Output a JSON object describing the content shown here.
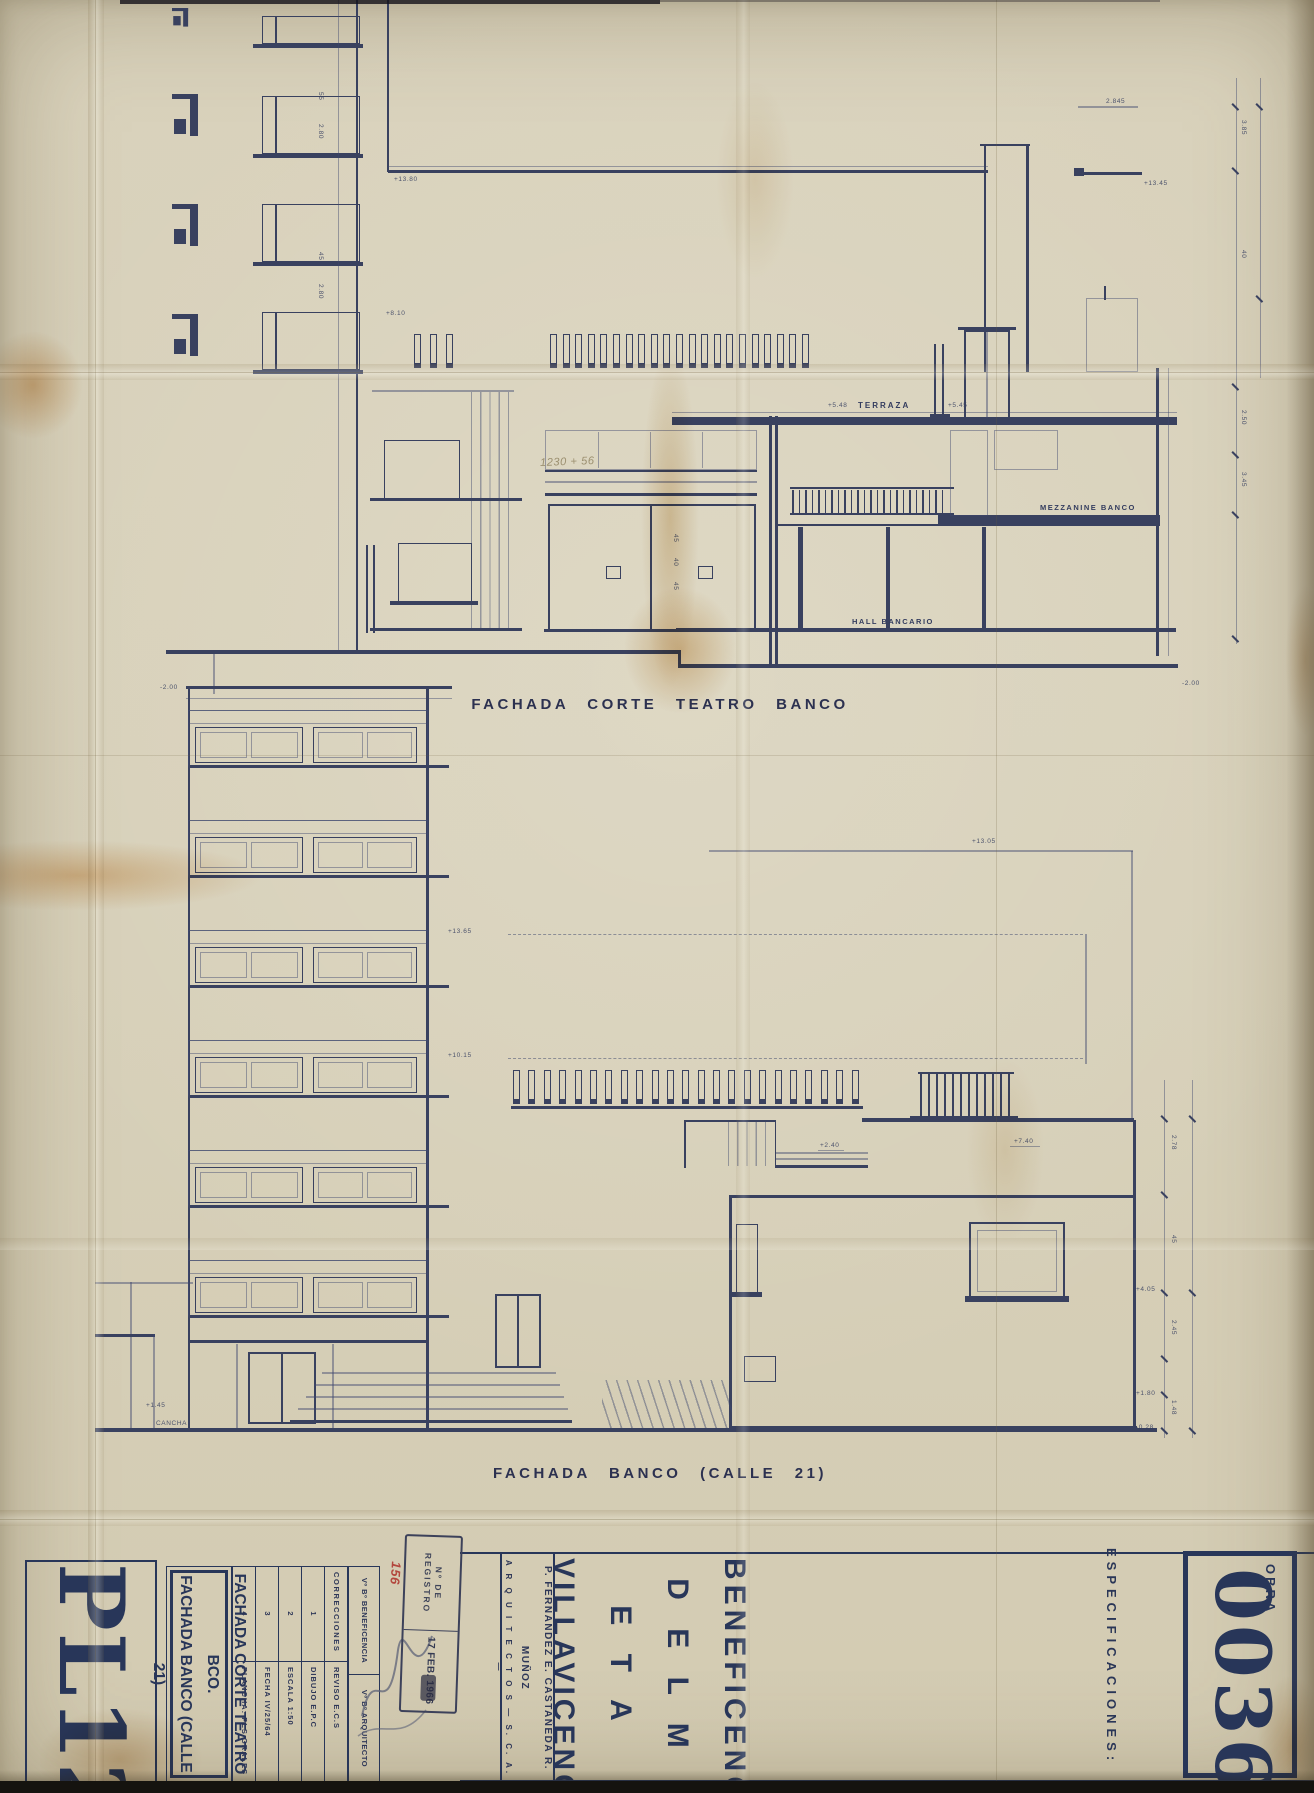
{
  "top": {
    "title": "FACHADA CORTE TEATRO BANCO",
    "terraza": "TERRAZA",
    "mezzanine": "MEZZANINE BANCO",
    "hall": "HALL BANCARIO",
    "lv_roof": "+13.80",
    "lv_845": "2.845",
    "lv_1345": "+13.45",
    "lv_548": "+5.48",
    "lv_545": "+5.45",
    "lv_810": "+8.10",
    "lv_gl": "-2.00",
    "lv_gr": "-2.00",
    "pencil": "1230 + 56",
    "rdims": [
      "3.85",
      "40",
      "2.50",
      "3.45"
    ],
    "ldims": [
      "55",
      "2.80",
      "45",
      "2.80"
    ],
    "adims": [
      "45",
      "40",
      "45"
    ]
  },
  "bottom": {
    "title": "FACHADA BANCO  (CALLE 21)",
    "lv_1365": "+13.65",
    "lv_1015": "+10.15",
    "lv_1305": "+13.05",
    "lv_740": "+7.40",
    "lv_240": "+2.40",
    "lv_405": "+4.05",
    "lv_180": "+1.80",
    "lv_028": "-0.28",
    "lv_145": "+1.45",
    "cancha": "CANCHA",
    "rdims": [
      "2.78",
      "45",
      "2.45",
      "1.48"
    ]
  },
  "tb": {
    "pl": "PL12",
    "t1": "FACHADA CORTE TEATRO BCO.",
    "t2": "FACHADA BANCO (CALLE 21)",
    "corr": {
      "r0": [
        "CORRECCIONES",
        "REVISO   E.C.S"
      ],
      "r1": [
        "1",
        "DIBUJO   E.P.C"
      ],
      "r2": [
        "2",
        "ESCALA   1:50"
      ],
      "r3": [
        "3",
        "FECHA   IV/25/64"
      ],
      "r4": [
        "4",
        "PLANCHA:  PLS  GRALES"
      ]
    },
    "vb1": "Vº Bº  BENEFICENCIA",
    "vb2": "Vº Bº  ARQUITECTO",
    "stamp1": "Nº  DE  REGISTRO",
    "stamp2": "17 FEB. 1966",
    "stamp_no": "156",
    "arch1": "P. FERNANDEZ      E. CASTAÑEDA      R. MUÑOZ",
    "arch2": "A R Q U I T E C T O S   —   S.  C.  A.  —",
    "cl1": "BENEFICENCIA",
    "cl2": "D E L    M E T A",
    "cl3": "VILLAVICENCIO",
    "specs": "ESPECIFICACIONES:",
    "obra": "OBRA",
    "obra_no": "0036"
  },
  "colors": {
    "paper": "#d8d1bb",
    "ink": "#39415f",
    "navy": "#283659",
    "red": "#b3473e"
  }
}
